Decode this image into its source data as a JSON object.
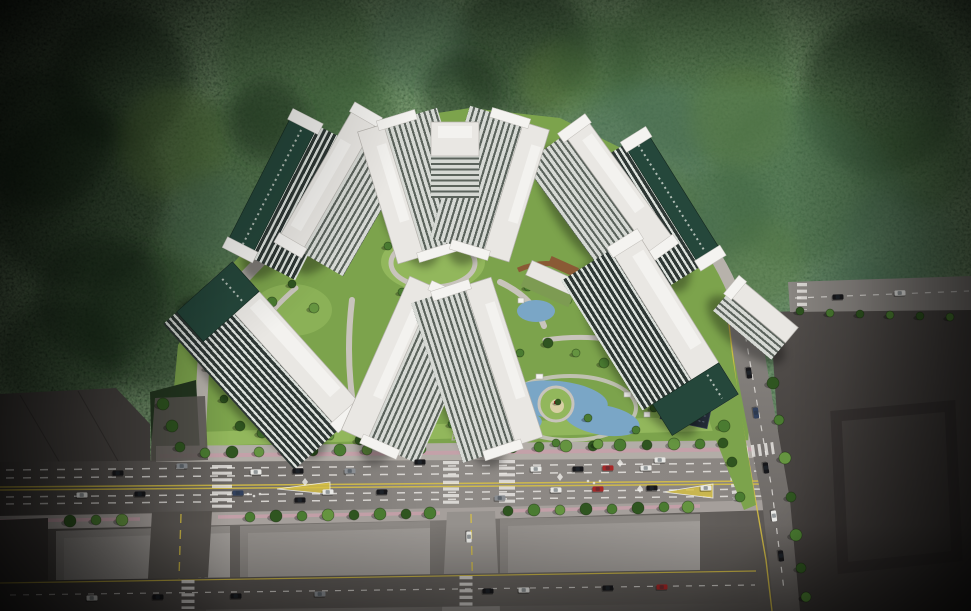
{
  "scene_description": "Aerial architectural rendering of a residential apartment complex: seven high-rise tower blocks in white and dark green around landscaped courtyards with a pond and playground island, dense forest behind, a multi-lane boulevard with crosswalks and traffic in front, warehouse rooftops and a large empty lot at the edges",
  "palette": {
    "forest_dark": "#162416",
    "forest_mid": "#2c4529",
    "forest_light": "#47663b",
    "lawn": "#7ca34c",
    "lawn_light": "#92b75c",
    "tree": "#4a7b31",
    "tree_dark": "#2f5520",
    "tree_light": "#659440",
    "path": "#c8c4bc",
    "ring": "#b7b2ab",
    "roof_white": "#e9e7e3",
    "roof_inner": "#f3f2ef",
    "parapet": "#f4f3f0",
    "facade_dark": "#2e3734",
    "facade_window": "#dce1dc",
    "facade_light": "#d6d9d4",
    "facade_light_window": "#5b635c",
    "accent_green": "#25473b",
    "pond": "#7aa6c6",
    "sidewalk": "#b2ada7",
    "sidewalk_pink": "#c79fa9",
    "boulevard": "#8b8783",
    "road_dark": "#4b4744",
    "lot": "#454140",
    "warehouse": "#4b4744",
    "marking_white": "#eceae6",
    "marking_yellow": "#d9c243"
  },
  "scene": {
    "tower_count": 7,
    "car_colors": [
      "#17171a",
      "#e9e9e6",
      "#898d92",
      "#a82626",
      "#32415e"
    ],
    "trees": [
      [
        205,
        453,
        5,
        0
      ],
      [
        232,
        452,
        6,
        1
      ],
      [
        259,
        452,
        5,
        2
      ],
      [
        286,
        451,
        6,
        0
      ],
      [
        313,
        451,
        5,
        1
      ],
      [
        340,
        450,
        6,
        0
      ],
      [
        367,
        450,
        5,
        2
      ],
      [
        394,
        449,
        6,
        1
      ],
      [
        421,
        449,
        5,
        0
      ],
      [
        512,
        447,
        6,
        1
      ],
      [
        539,
        447,
        5,
        0
      ],
      [
        566,
        446,
        6,
        2
      ],
      [
        593,
        446,
        5,
        1
      ],
      [
        620,
        445,
        6,
        0
      ],
      [
        647,
        445,
        5,
        1
      ],
      [
        674,
        444,
        6,
        2
      ],
      [
        700,
        444,
        5,
        0
      ],
      [
        723,
        443,
        5,
        1
      ],
      [
        70,
        521,
        6,
        1
      ],
      [
        96,
        520,
        5,
        0
      ],
      [
        122,
        520,
        6,
        2
      ],
      [
        250,
        517,
        5,
        0
      ],
      [
        276,
        516,
        6,
        1
      ],
      [
        302,
        516,
        5,
        0
      ],
      [
        328,
        515,
        6,
        2
      ],
      [
        354,
        515,
        5,
        1
      ],
      [
        380,
        514,
        6,
        0
      ],
      [
        406,
        514,
        5,
        1
      ],
      [
        430,
        513,
        6,
        0
      ],
      [
        508,
        511,
        5,
        1
      ],
      [
        534,
        510,
        6,
        0
      ],
      [
        560,
        510,
        5,
        2
      ],
      [
        586,
        509,
        6,
        1
      ],
      [
        612,
        509,
        5,
        0
      ],
      [
        638,
        508,
        6,
        1
      ],
      [
        664,
        507,
        5,
        0
      ],
      [
        688,
        507,
        6,
        2
      ],
      [
        767,
        345,
        5,
        0
      ],
      [
        773,
        383,
        6,
        1
      ],
      [
        779,
        420,
        5,
        0
      ],
      [
        785,
        458,
        6,
        2
      ],
      [
        791,
        497,
        5,
        1
      ],
      [
        796,
        535,
        6,
        0
      ],
      [
        801,
        568,
        5,
        1
      ],
      [
        806,
        597,
        5,
        0
      ],
      [
        716,
        390,
        5,
        1
      ],
      [
        724,
        426,
        6,
        0
      ],
      [
        732,
        462,
        5,
        1
      ],
      [
        740,
        497,
        5,
        0
      ],
      [
        800,
        311,
        4,
        1
      ],
      [
        830,
        313,
        4,
        0
      ],
      [
        860,
        314,
        4,
        1
      ],
      [
        890,
        315,
        4,
        0
      ],
      [
        920,
        316,
        4,
        1
      ],
      [
        950,
        317,
        4,
        0
      ],
      [
        163,
        404,
        6,
        1
      ],
      [
        172,
        426,
        6,
        1
      ],
      [
        180,
        447,
        5,
        1
      ],
      [
        388,
        246,
        4,
        0
      ],
      [
        412,
        234,
        4,
        2
      ],
      [
        452,
        232,
        4,
        0
      ],
      [
        478,
        248,
        4,
        1
      ],
      [
        402,
        292,
        4,
        0
      ],
      [
        446,
        298,
        4,
        1
      ],
      [
        425,
        307,
        4,
        2
      ],
      [
        272,
        302,
        5,
        0
      ],
      [
        292,
        284,
        4,
        1
      ],
      [
        314,
        308,
        5,
        2
      ],
      [
        268,
        332,
        4,
        0
      ],
      [
        240,
        426,
        5,
        1
      ],
      [
        262,
        433,
        5,
        0
      ],
      [
        224,
        399,
        4,
        1
      ],
      [
        208,
        368,
        4,
        0
      ],
      [
        198,
        341,
        4,
        1
      ],
      [
        520,
        353,
        4,
        0
      ],
      [
        548,
        343,
        5,
        1
      ],
      [
        576,
        353,
        4,
        2
      ],
      [
        604,
        363,
        5,
        0
      ],
      [
        630,
        378,
        4,
        1
      ],
      [
        658,
        396,
        5,
        0
      ],
      [
        678,
        413,
        4,
        1
      ],
      [
        300,
        430,
        5,
        0
      ],
      [
        330,
        436,
        4,
        2
      ],
      [
        360,
        440,
        5,
        1
      ],
      [
        506,
        381,
        4,
        0
      ],
      [
        516,
        438,
        5,
        1
      ],
      [
        556,
        443,
        4,
        0
      ],
      [
        598,
        444,
        5,
        2
      ],
      [
        636,
        430,
        4,
        0
      ],
      [
        654,
        408,
        4,
        1
      ],
      [
        640,
        389,
        4,
        2
      ],
      [
        558,
        402,
        3,
        1
      ],
      [
        528,
        287,
        4,
        0
      ],
      [
        568,
        300,
        4,
        2
      ],
      [
        592,
        283,
        4,
        1
      ],
      [
        614,
        311,
        5,
        0
      ],
      [
        640,
        331,
        4,
        1
      ],
      [
        662,
        348,
        5,
        2
      ],
      [
        690,
        372,
        5,
        0
      ],
      [
        700,
        398,
        4,
        1
      ],
      [
        588,
        418,
        4,
        0
      ],
      [
        488,
        430,
        4,
        2
      ],
      [
        452,
        424,
        4,
        0
      ],
      [
        418,
        428,
        4,
        1
      ]
    ],
    "cars": [
      [
        182,
        466,
        -1,
        2
      ],
      [
        420,
        462,
        -1,
        0
      ],
      [
        660,
        460,
        -1,
        1
      ],
      [
        118,
        473,
        -1,
        0
      ],
      [
        256,
        472,
        -1,
        1
      ],
      [
        298,
        471,
        -1,
        0
      ],
      [
        350,
        471,
        -1,
        2
      ],
      [
        536,
        469,
        -1,
        1
      ],
      [
        578,
        469,
        -1,
        0
      ],
      [
        608,
        468,
        -1,
        3
      ],
      [
        646,
        468,
        -1,
        1
      ],
      [
        82,
        495,
        -1,
        1
      ],
      [
        140,
        494,
        -1,
        0
      ],
      [
        238,
        493,
        -1,
        4
      ],
      [
        328,
        492,
        -1,
        1
      ],
      [
        382,
        492,
        -1,
        0
      ],
      [
        556,
        490,
        -1,
        1
      ],
      [
        598,
        489,
        -1,
        3
      ],
      [
        652,
        488,
        -1,
        0
      ],
      [
        706,
        488,
        -1,
        1
      ],
      [
        300,
        500,
        -1,
        0
      ],
      [
        500,
        498,
        -1,
        2
      ],
      [
        469,
        537,
        89,
        1
      ],
      [
        92,
        598,
        -1,
        1
      ],
      [
        158,
        597,
        -1,
        0
      ],
      [
        236,
        596,
        -1,
        0
      ],
      [
        320,
        594,
        -1,
        2
      ],
      [
        488,
        591,
        -1,
        0
      ],
      [
        524,
        590,
        -1,
        1
      ],
      [
        608,
        588,
        -1,
        0
      ],
      [
        662,
        587,
        -1,
        3
      ],
      [
        749,
        373,
        82,
        0
      ],
      [
        756,
        413,
        82,
        4
      ],
      [
        766,
        468,
        82,
        0
      ],
      [
        774,
        516,
        83,
        1
      ],
      [
        781,
        556,
        83,
        0
      ],
      [
        838,
        297,
        -2,
        0
      ],
      [
        900,
        293,
        -2,
        1
      ]
    ],
    "forest_blobs": [
      [
        120,
        80,
        70,
        1
      ],
      [
        300,
        60,
        80,
        0
      ],
      [
        520,
        50,
        70,
        1
      ],
      [
        700,
        70,
        90,
        0
      ],
      [
        880,
        95,
        80,
        1
      ],
      [
        80,
        200,
        90,
        1
      ],
      [
        230,
        160,
        60,
        0
      ],
      [
        420,
        44,
        50,
        2
      ],
      [
        640,
        150,
        70,
        2
      ],
      [
        800,
        180,
        85,
        0
      ],
      [
        900,
        245,
        60,
        2
      ],
      [
        150,
        320,
        70,
        1
      ],
      [
        60,
        360,
        62,
        1
      ],
      [
        740,
        120,
        50,
        3
      ],
      [
        560,
        82,
        40,
        3
      ],
      [
        855,
        315,
        55,
        2
      ],
      [
        920,
        160,
        50,
        0
      ],
      [
        200,
        262,
        50,
        0
      ],
      [
        680,
        252,
        55,
        2
      ],
      [
        758,
        262,
        45,
        3
      ],
      [
        172,
        142,
        55,
        3
      ],
      [
        350,
        112,
        45,
        0
      ],
      [
        462,
        92,
        40,
        1
      ],
      [
        600,
        62,
        45,
        0
      ],
      [
        102,
        300,
        65,
        1
      ],
      [
        40,
        140,
        70,
        1
      ],
      [
        210,
        218,
        45,
        2
      ],
      [
        268,
        120,
        40,
        1
      ],
      [
        725,
        210,
        45,
        0
      ],
      [
        655,
        205,
        40,
        3
      ]
    ]
  }
}
